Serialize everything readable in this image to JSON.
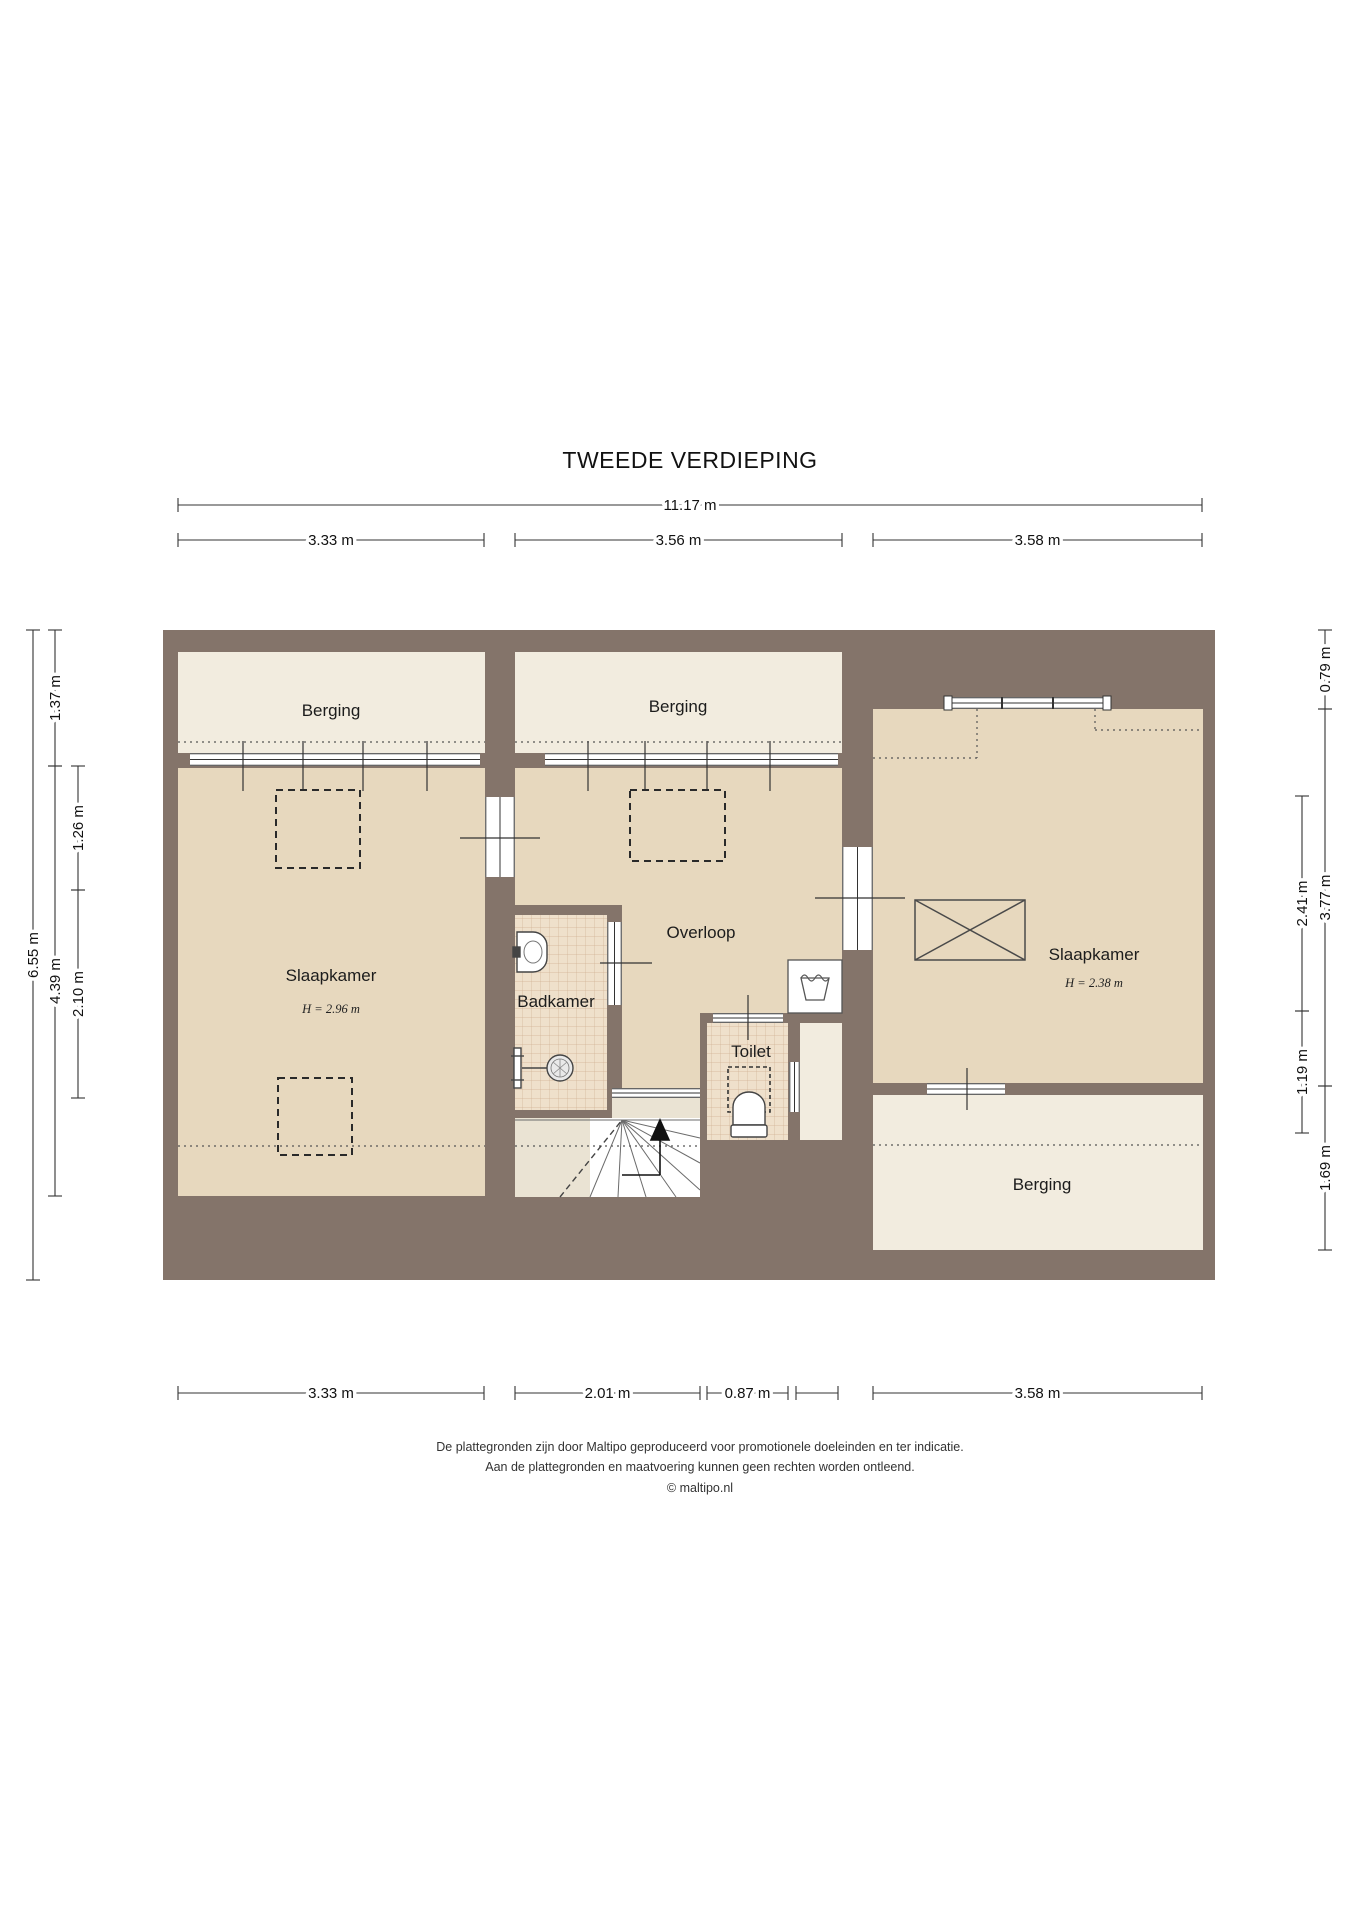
{
  "title": "TWEEDE VERDIEPING",
  "rooms": [
    {
      "id": "berging-left",
      "label": "Berging"
    },
    {
      "id": "berging-middle",
      "label": "Berging"
    },
    {
      "id": "slaapkamer-left",
      "label": "Slaapkamer",
      "height_label": "H = 2.96 m"
    },
    {
      "id": "overloop",
      "label": "Overloop"
    },
    {
      "id": "badkamer",
      "label": "Badkamer"
    },
    {
      "id": "toilet",
      "label": "Toilet"
    },
    {
      "id": "slaapkamer-right",
      "label": "Slaapkamer",
      "height_label": "H = 2.38 m"
    },
    {
      "id": "berging-right",
      "label": "Berging"
    }
  ],
  "dimensions": {
    "top_total": "11.17 m",
    "top_segments": [
      "3.33 m",
      "3.56 m",
      "3.58 m"
    ],
    "bottom_segments": [
      "3.33 m",
      "2.01 m",
      "0.87 m",
      "3.58 m"
    ],
    "left_outer": "6.55 m",
    "left_mid": [
      "1.37 m",
      "4.39 m"
    ],
    "left_inner": [
      "1.26 m",
      "2.10 m"
    ],
    "right_outer": [
      "0.79 m",
      "3.77 m",
      "1.69 m"
    ],
    "right_inner": [
      "2.41 m",
      "1.19 m"
    ]
  },
  "footer": {
    "line1": "De plattegronden zijn door Maltipo geproduceerd voor promotionele doeleinden en ter indicatie.",
    "line2": "Aan de plattegronden en maatvoering kunnen geen rechten worden ontleend.",
    "copyright": "© maltipo.nl"
  },
  "colors": {
    "wall": "#84746a",
    "berging_floor": "#f2ecdf",
    "room_floor": "#e7d8be",
    "tile_floor": "#efe0cb",
    "tile_grid": "#c7a584",
    "stairs_side": "#eae3d3",
    "line_dark": "#333333",
    "line_mid": "#555555",
    "stair_line": "#6b6b6b",
    "text": "#1c1c1c"
  }
}
